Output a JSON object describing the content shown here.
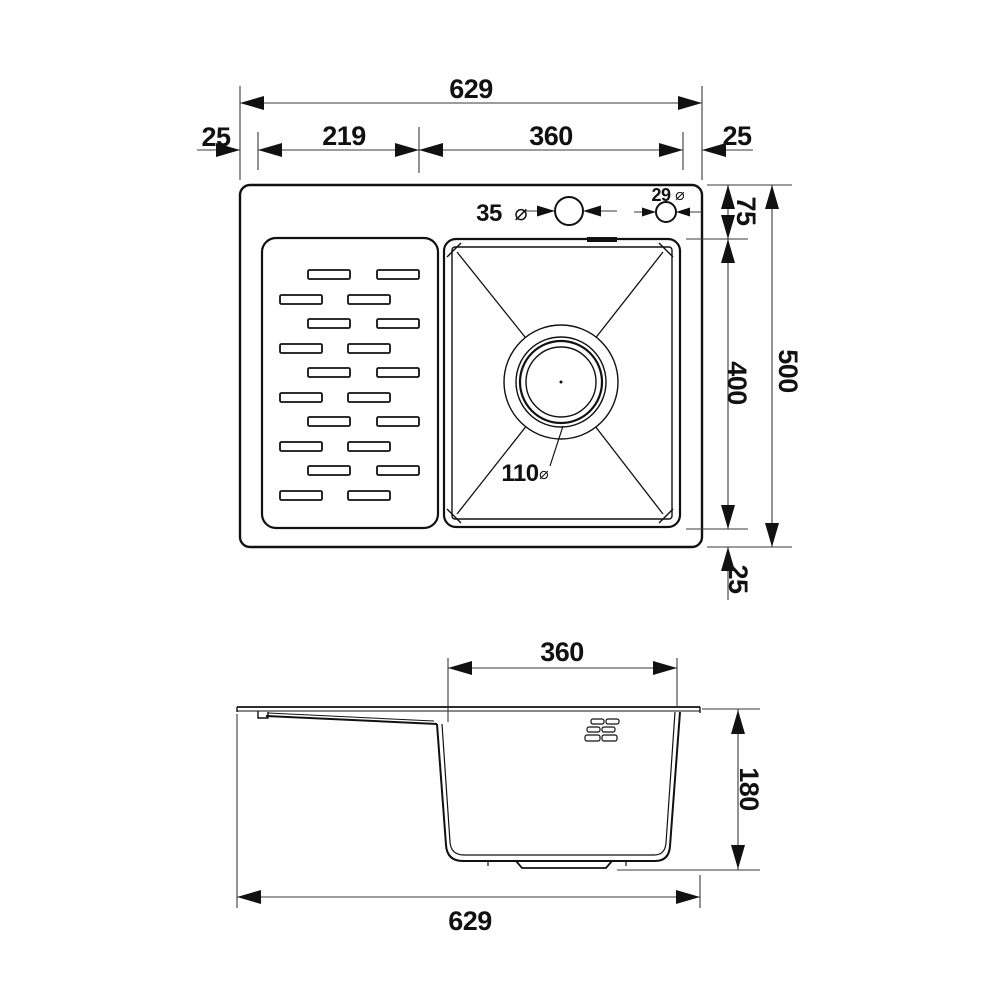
{
  "drawing": {
    "type": "technical-dimension-drawing",
    "subject": "kitchen-sink-with-drainboard",
    "units_implied": "mm",
    "colors": {
      "outline": "#111111",
      "dimension": "#3a3a3a",
      "background": "#ffffff"
    },
    "symbols": {
      "diameter": "⌀"
    },
    "top_view": {
      "dims": {
        "overall_width": "629",
        "left_offset": "25",
        "drainboard_width": "219",
        "bowl_width": "360",
        "right_offset": "25",
        "top_offset": "75",
        "bowl_length": "400",
        "overall_depth": "500",
        "bottom_offset": "25",
        "faucet_hole_diameter": "35",
        "accessory_hole_diameter": "29",
        "drain_diameter": "110"
      }
    },
    "side_view": {
      "dims": {
        "bowl_width": "360",
        "bowl_depth": "180",
        "overall_width": "629"
      }
    }
  }
}
